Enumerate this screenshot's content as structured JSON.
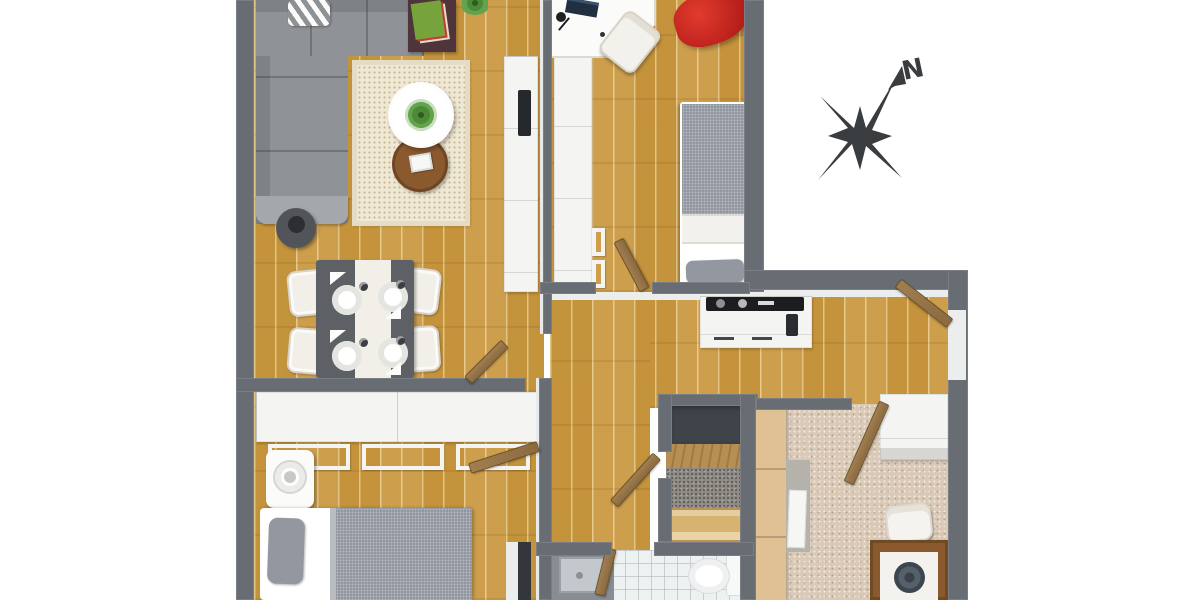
{
  "scene": {
    "description": "Top-down 3D rendered floor plan of an apartment on a white background",
    "background_color": "#ffffff"
  },
  "compass": {
    "label": "N"
  },
  "colors": {
    "wood": "#c9983f",
    "wall": "#686d73",
    "wall_face": "#eceded",
    "unit_white": "#f4f4f2",
    "sofa": "#8f9397",
    "sofa_back": "#7e8286",
    "sofa_arm": "#a4a8ac",
    "rug": "#efe8d4",
    "rug_border": "#e4dcc4",
    "red_beanbag": "#c22418",
    "bed_gray": "#9297a0",
    "bed_white": "#f4f3f0",
    "carpet_beige": "#d9c9b6",
    "carpet_gray": "#8f8b85",
    "door_wood": "#8a6a40",
    "console_wood": "#4f353b",
    "table_wood": "#8a5a2e",
    "dining_table": "#5d6165",
    "tile": "#eef1f2",
    "dark_panel": "#33363a",
    "compass_color": "#3a3d40",
    "plant": "#4c8a38",
    "cabinet_tan": "#e0c193",
    "chest_tan": "#d7b271",
    "cooktop": "#1b1d1f",
    "shower_rim": "#878d93"
  },
  "rooms": [
    {
      "name": "living-dining-room",
      "floor": "wood"
    },
    {
      "name": "bedroom-top",
      "floor": "wood"
    },
    {
      "name": "kitchen-hallway",
      "floor": "wood"
    },
    {
      "name": "bedroom-bottom-left",
      "floor": "wood"
    },
    {
      "name": "walk-in-closet",
      "floor": "gray-carpet"
    },
    {
      "name": "office-bottom-right",
      "floor": "beige-carpet"
    },
    {
      "name": "bathroom",
      "floor": "white-tile"
    }
  ],
  "furniture": [
    "corner-sofa",
    "striped-pillow",
    "console-with-magazines",
    "potted-plant",
    "area-rug",
    "round-coffee-table-with-plant",
    "round-side-table",
    "dark-stool",
    "tv-cabinet",
    "wall-tv",
    "corner-desk-with-laptop",
    "desk-lamp",
    "desk-chair",
    "red-beanbag",
    "single-bed",
    "wardrobe-column",
    "kitchen-counter-with-cooktop",
    "dining-table-with-runner",
    "four-place-settings",
    "four-dining-chairs",
    "built-in-wardrobe",
    "open-shelf-frames",
    "nightstand-with-lamp",
    "double-bed",
    "dark-niche",
    "wooden-mat",
    "storage-chest",
    "tall-tan-cabinets",
    "mirror-panel",
    "office-wardrobe",
    "office-chair",
    "office-desk-with-bowl",
    "shower-stall",
    "toilet",
    "entry-door",
    "interior-doors"
  ]
}
